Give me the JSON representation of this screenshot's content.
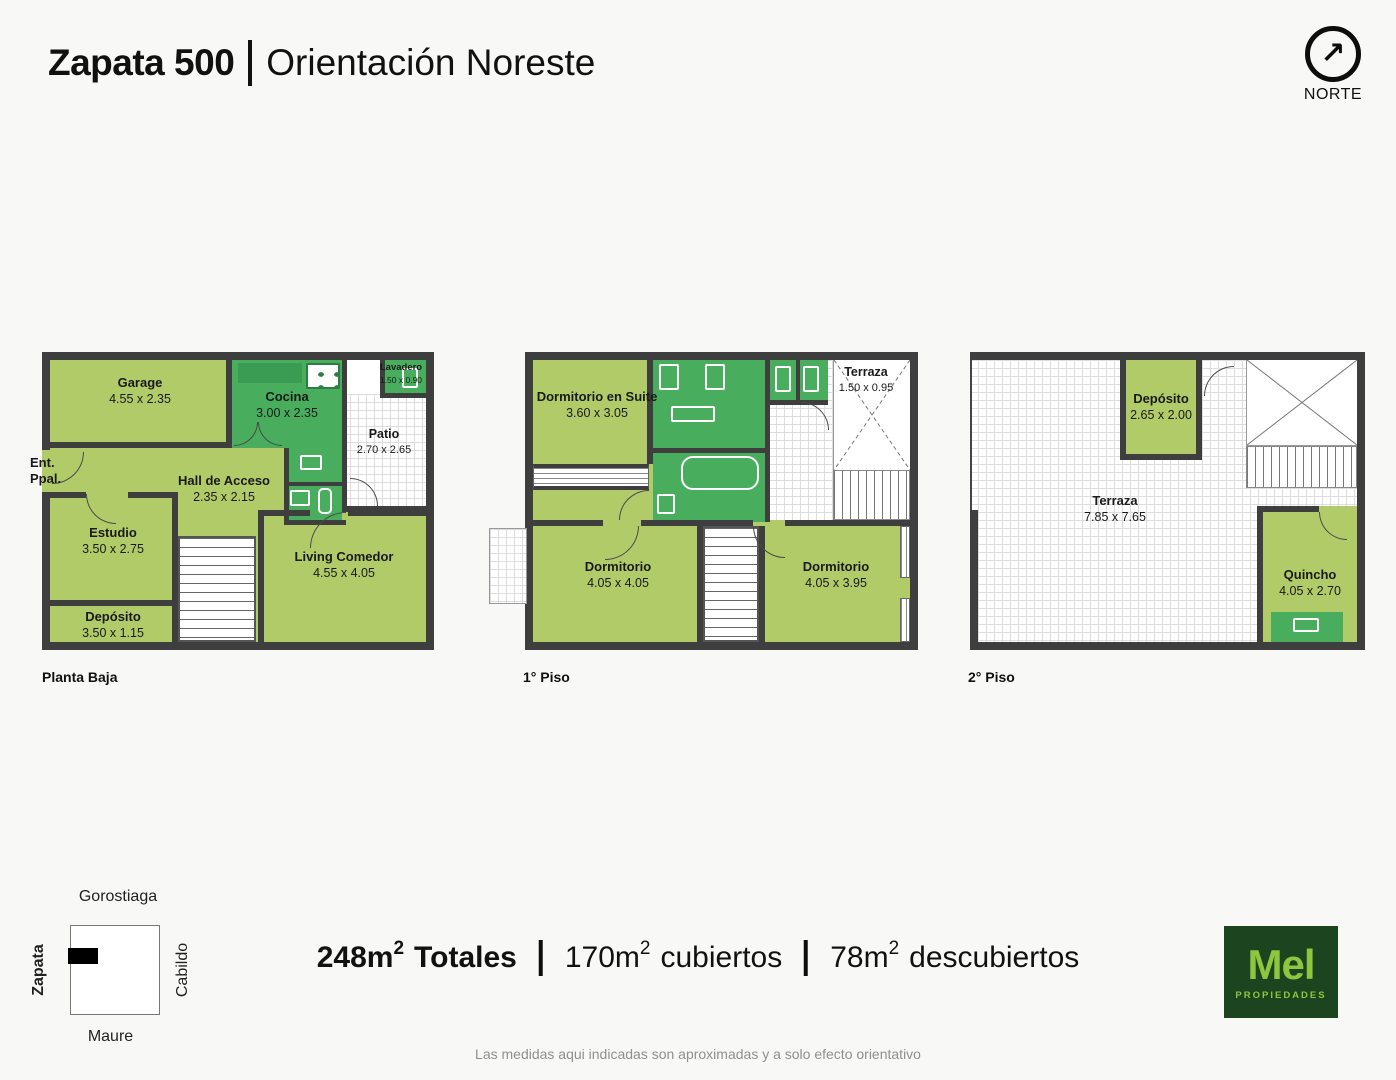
{
  "header": {
    "title_bold": "Zapata 500",
    "title_regular": "Orientación Noreste"
  },
  "north": {
    "arrow": "↗",
    "label": "NORTE"
  },
  "plans": [
    {
      "label": "Planta Baja",
      "rooms": {
        "garage": {
          "name": "Garage",
          "dims": "4.55 x 2.35"
        },
        "cocina": {
          "name": "Cocina",
          "dims": "3.00 x 2.35"
        },
        "lavadero": {
          "name": "Lavadero",
          "dims": "1.50 x 0.90"
        },
        "patio": {
          "name": "Patio",
          "dims": "2.70 x 2.65"
        },
        "hall": {
          "name": "Hall de Acceso",
          "dims": "2.35 x 2.15"
        },
        "estudio": {
          "name": "Estudio",
          "dims": "3.50 x 2.75"
        },
        "deposito": {
          "name": "Depósito",
          "dims": "3.50 x 1.15"
        },
        "living": {
          "name": "Living Comedor",
          "dims": "4.55 x 4.05"
        },
        "entrada": {
          "name": "Ent. Ppal."
        }
      }
    },
    {
      "label": "1° Piso",
      "rooms": {
        "suite": {
          "name": "Dormitorio en Suite",
          "dims": "3.60 x 3.05"
        },
        "terraza": {
          "name": "Terraza",
          "dims": "1.50 x 0.95"
        },
        "dorm1": {
          "name": "Dormitorio",
          "dims": "4.05 x 4.05"
        },
        "dorm2": {
          "name": "Dormitorio",
          "dims": "4.05 x 3.95"
        }
      }
    },
    {
      "label": "2° Piso",
      "rooms": {
        "deposito": {
          "name": "Depósito",
          "dims": "2.65 x 2.00"
        },
        "terraza": {
          "name": "Terraza",
          "dims": "7.85 x 7.65"
        },
        "quincho": {
          "name": "Quincho",
          "dims": "4.05 x 2.70"
        }
      }
    }
  ],
  "map": {
    "top": "Gorostiaga",
    "left": "Zapata",
    "right": "Cabildo",
    "bottom": "Maure"
  },
  "totals": {
    "total": {
      "value": "248m",
      "sup": "2",
      "label": "Totales"
    },
    "covered": {
      "value": "170m",
      "sup": "2",
      "label": "cubiertos"
    },
    "uncovered": {
      "value": "78m",
      "sup": "2",
      "label": "descubiertos"
    }
  },
  "logo": {
    "brand": "Mel",
    "sub": "PROPIEDADES"
  },
  "footer": {
    "disclaimer": "Las medidas aqui indicadas son aproximadas y a solo efecto orientativo"
  },
  "colors": {
    "wall": "#3e3e3e",
    "room_light": "#b2cb69",
    "room_dark": "#48ae5e",
    "room_darker": "#3a9b52",
    "tile_line": "#dddddd",
    "logo_bg": "#1c441f",
    "logo_green": "#8dc63f",
    "gray": "#8f8f8f"
  }
}
